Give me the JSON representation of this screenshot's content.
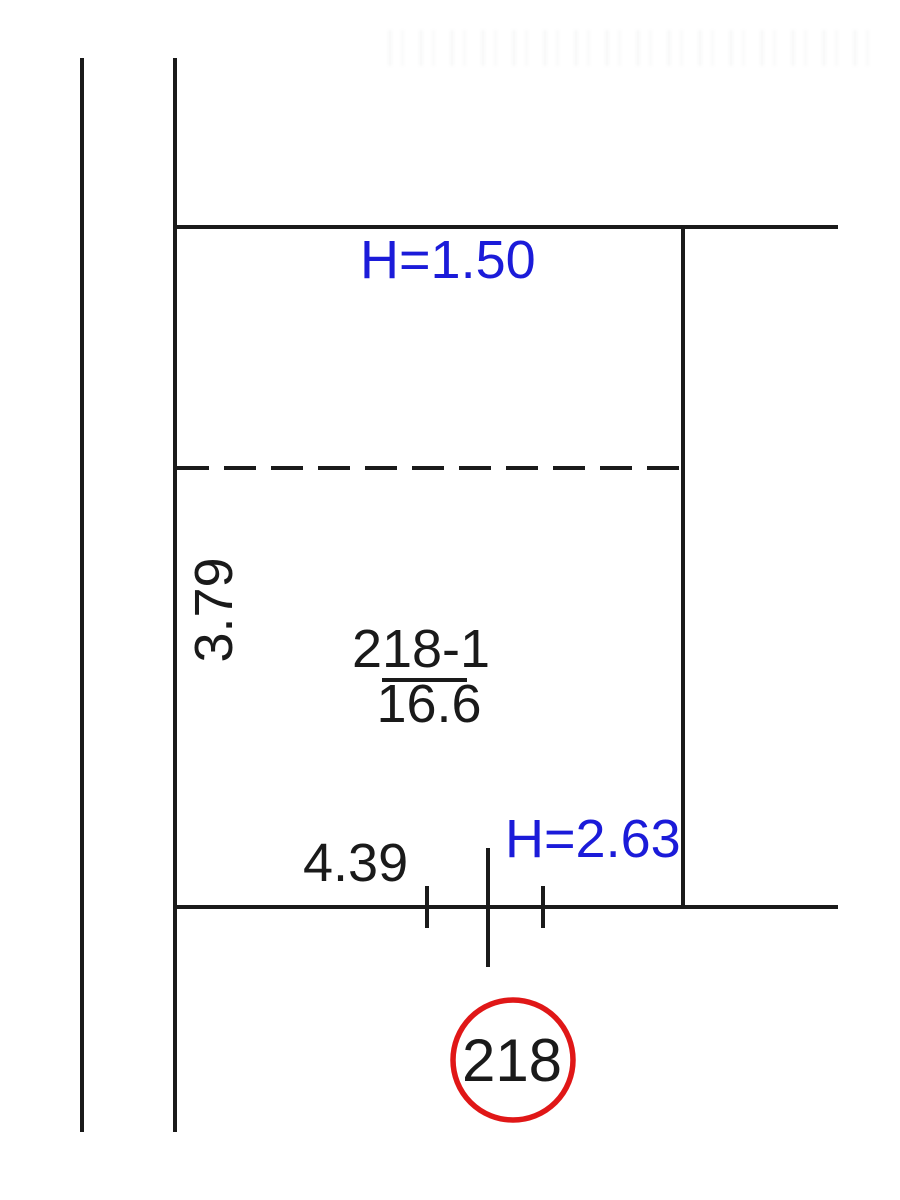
{
  "colors": {
    "line": "#1a1a1a",
    "text": "#1a1a1a",
    "height_label": "#1b1bd9",
    "point_circle": "#e01717",
    "bg": "#ffffff"
  },
  "plan": {
    "heights": [
      {
        "id": "upper-section",
        "label": "H=1.50"
      },
      {
        "id": "lower-section",
        "label": "H=2.63"
      }
    ],
    "dimensions": [
      {
        "id": "side-length",
        "label": "3.79"
      },
      {
        "id": "bottom-length",
        "label": "4.39"
      }
    ],
    "parcel": {
      "number": "218-1",
      "area": "16.6"
    },
    "survey_point": {
      "number": "218"
    }
  }
}
